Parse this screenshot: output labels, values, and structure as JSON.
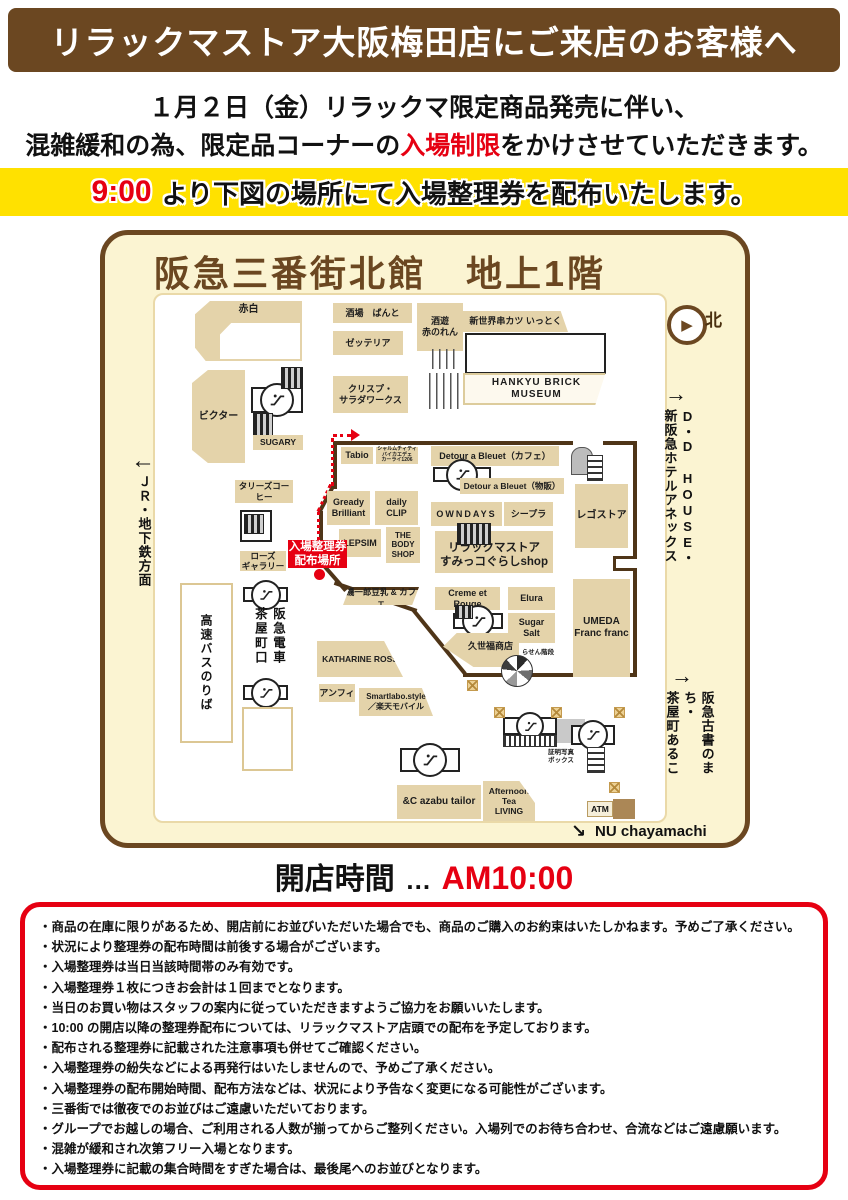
{
  "header": {
    "title": "リラックマストア大阪梅田店にご来店のお客様へ"
  },
  "notice": {
    "line1": "１月２日（金）リラックマ限定商品発売に伴い、",
    "line2_pre": "混雑緩和の為、限定品コーナーの",
    "line2_highlight": "入場制限",
    "line2_post": "をかけさせていただきます。"
  },
  "ticket_banner": {
    "time": "9:00",
    "text": "より下図の場所にて入場整理券を配布いたします。"
  },
  "map": {
    "title": "阪急三番街北館　地上1階",
    "north_label": "北",
    "badge_label": "入場整理券\n配布場所",
    "labels": {
      "akashiro": "赤白",
      "sakaba": "酒場　ばんと",
      "shuyu": "酒遊\n赤のれん",
      "shinsekai": "新世界串カツ いっとく",
      "zetteria": "ゼッテリア",
      "crisp": "クリスプ・\nサラダワークス",
      "museum": "HANKYU BRICK MUSEUM",
      "victor": "ビクター",
      "sugary": "SUGARY",
      "tullys": "タリーズコーヒー",
      "rose": "ローズ\nギャラリー",
      "tabio": "Tabio",
      "charm": "シャルムチィティ\nバイカエデェ\nカーライ1206",
      "detour_cafe": "Detour a Bleuet（カフェ）",
      "detour_shop": "Detour a Bleuet（物販）",
      "gready": "Gready\nBrilliant",
      "daily_clip": "daily\nCLIP",
      "owndays": "OWNDAYS",
      "cpla": "シープラ",
      "lego": "レゴストア",
      "lepsim": "LEPSIM",
      "bodyshop": "THE\nBODY\nSHOP",
      "rilakkuma": "リラックマストア\nすみっコぐらしshop",
      "tonyu": "磯一郎豆乳 & カフェ",
      "creme": "Creme et Rouge",
      "elura": "Elura",
      "sugarsalt": "Sugar\nSalt",
      "francfranc": "UMEDA\nFranc franc",
      "kuzefuku": "久世福商店",
      "rasen": "らせん階段",
      "katharine": "KATHARINE ROSS",
      "amphi": "アンフィ",
      "smartlabo": "Smartlabo.style\n／楽天モバイル",
      "azabu": "&C azabu tailor",
      "afternoon": "Afternoon\nTea\nLIVING",
      "atm": "ATM",
      "photo_booth": "証明写真\nボックス",
      "bus": "高速バスのりば",
      "chayamachi_gate": "阪急電車\n茶屋町口"
    },
    "exits": {
      "jr": {
        "arrow": "←",
        "label": "ＪＲ・地下鉄方面"
      },
      "dd_house": {
        "arrow": "→",
        "label": "D・D HOUSE・\n新阪急ホテルアネックス"
      },
      "kosho": {
        "arrow": "→",
        "label": "阪急古書のまち・\n茶屋町あるこ"
      },
      "nu": {
        "arrow": "↘",
        "label": "NU chayamachi"
      }
    }
  },
  "opening": {
    "label": "開店時間",
    "ellipsis": "…",
    "time": "AM10:00"
  },
  "notes": {
    "items": [
      "・商品の在庫に限りがあるため、開店前にお並びいただいた場合でも、商品のご購入のお約束はいたしかねます。予めご了承ください。",
      "・状況により整理券の配布時間は前後する場合がございます。",
      "・入場整理券は当日当該時間帯のみ有効です。",
      "・入場整理券１枚につきお会計は１回までとなります。",
      "・当日のお買い物はスタッフの案内に従っていただきますようご協力をお願いいたします。",
      "・10:00 の開店以降の整理券配布については、リラックマストア店頭での配布を予定しております。",
      "・配布される整理券に記載された注意事項も併せてご確認ください。",
      "・入場整理券の紛失などによる再発行はいたしませんので、予めご了承ください。",
      "・入場整理券の配布開始時間、配布方法などは、状況により予告なく変更になる可能性がございます。",
      "・三番街では徹夜でのお並びはご遠慮いただいております。",
      "・グループでお越しの場合、ご利用される人数が揃ってからご整列ください。入場列でのお待ち合わせ、合流などはご遠慮願います。",
      "・混雑が緩和され次第フリー入場となります。",
      "・入場整理券に記載の集合時間をすぎた場合は、最後尾へのお並びとなります。"
    ]
  }
}
